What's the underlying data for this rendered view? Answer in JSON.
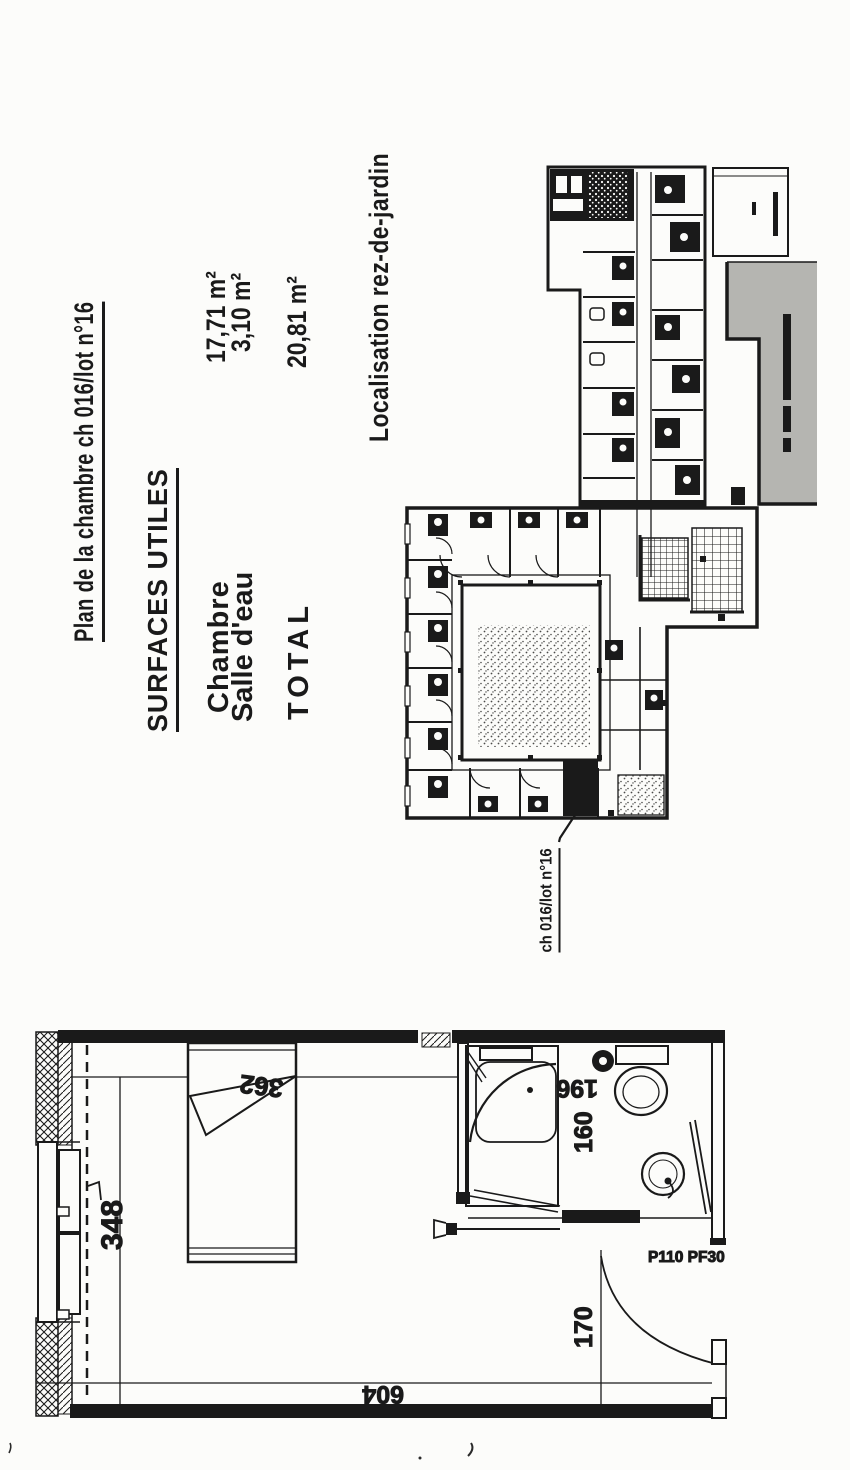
{
  "page": {
    "title": "Plan de la chambre ch 016/lot n°16",
    "surfaces_heading": "SURFACES UTILES",
    "surfaces": [
      {
        "label": "Chambre",
        "value": "17,71 m²"
      },
      {
        "label": "Salle d'eau",
        "value": "3,10 m²"
      },
      {
        "label": "TOTAL",
        "value": "20,81 m²"
      }
    ],
    "localisation_heading": "Localisation rez-de-jardin",
    "room_callout": "ch 016/lot n°16",
    "dims": {
      "d348": "348",
      "d362": "362",
      "d196": "196",
      "d160": "160",
      "d170": "170",
      "d604": "604"
    },
    "door_label": "P110 PF30",
    "colors": {
      "ink": "#1a1a1a",
      "paper": "#fcfcfa",
      "terrace_grey": "#b5b5b1"
    }
  }
}
